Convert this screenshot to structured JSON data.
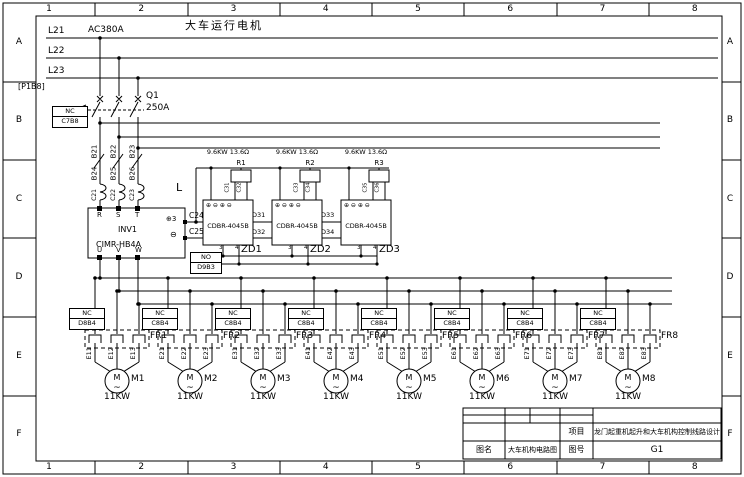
{
  "border": {
    "cols": [
      "1",
      "2",
      "3",
      "4",
      "5",
      "6",
      "7",
      "8"
    ],
    "rows": [
      "A",
      "B",
      "C",
      "D",
      "E",
      "F"
    ]
  },
  "power": {
    "title": "大车运行电机",
    "voltage": "AC380A",
    "ref": "[P1B8]",
    "lines": [
      "L21",
      "L22",
      "L23"
    ]
  },
  "breaker": {
    "name": "Q1",
    "rating": "250A",
    "nc_label": "NC",
    "nc_code": "C7B8"
  },
  "feeder": {
    "wires_in": [
      "B21",
      "B22",
      "B23"
    ],
    "wires_mid": [
      "B24",
      "B25",
      "B26"
    ],
    "wires_out": [
      "C21",
      "C22",
      "C23"
    ],
    "reactor": "L"
  },
  "inverter": {
    "name": "INV1",
    "model": "CIMR-HB4A",
    "in": [
      "R",
      "S",
      "T"
    ],
    "out": [
      "U",
      "V",
      "W"
    ],
    "dc_plus_sym": "⊕3",
    "dc_minus_sym": "⊖",
    "dc_plus_wire": "C24",
    "dc_minus_wire": "C25"
  },
  "no_box": {
    "label": "NO",
    "code": "D9B3"
  },
  "braking": {
    "terminals": "⊕ ⊖ ⊕ ⊖",
    "links": [
      "D31",
      "D32",
      "D33",
      "D34"
    ],
    "units": [
      {
        "name": "ZD1",
        "model": "CDBR-4045B",
        "resistor": "R1",
        "spec": "9.6KW 13.6Ω",
        "lead1": "C31",
        "lead2": "C32",
        "t3": "3",
        "t4": "4"
      },
      {
        "name": "ZD2",
        "model": "CDBR-4045B",
        "resistor": "R2",
        "spec": "9.6KW 13.6Ω",
        "lead1": "C33",
        "lead2": "C34",
        "t3": "3",
        "t4": "4"
      },
      {
        "name": "ZD3",
        "model": "CDBR-4045B",
        "resistor": "R3",
        "spec": "9.6KW 13.6Ω",
        "lead1": "C35",
        "lead2": "C36",
        "t3": "3",
        "t4": "4"
      }
    ]
  },
  "motor_glyph": {
    "letter": "M",
    "wave": "~"
  },
  "motors": [
    {
      "name": "M1",
      "power": "11KW",
      "fr": "FR1",
      "nc": "NC",
      "code": "D8B4",
      "wires": [
        "E11",
        "E12",
        "E13"
      ]
    },
    {
      "name": "M2",
      "power": "11KW",
      "fr": "FR2",
      "nc": "NC",
      "code": "C8B4",
      "wires": [
        "E21",
        "E22",
        "E23"
      ]
    },
    {
      "name": "M3",
      "power": "11KW",
      "fr": "FR3",
      "nc": "NC",
      "code": "C8B4",
      "wires": [
        "E31",
        "E32",
        "E33"
      ]
    },
    {
      "name": "M4",
      "power": "11KW",
      "fr": "FR4",
      "nc": "NC",
      "code": "C8B4",
      "wires": [
        "E41",
        "E42",
        "E43"
      ]
    },
    {
      "name": "M5",
      "power": "11KW",
      "fr": "FR5",
      "nc": "NC",
      "code": "C8B4",
      "wires": [
        "E51",
        "E52",
        "E53"
      ]
    },
    {
      "name": "M6",
      "power": "11KW",
      "fr": "FR6",
      "nc": "NC",
      "code": "C8B4",
      "wires": [
        "E61",
        "E62",
        "E63"
      ]
    },
    {
      "name": "M7",
      "power": "11KW",
      "fr": "FR7",
      "nc": "NC",
      "code": "C8B4",
      "wires": [
        "E71",
        "E72",
        "E73"
      ]
    },
    {
      "name": "M8",
      "power": "11KW",
      "fr": "FR8",
      "nc": "NC",
      "code": "C8B4",
      "wires": [
        "E81",
        "E82",
        "E83"
      ]
    }
  ],
  "titleblock": {
    "project_label": "项目",
    "project": "龙门起重机起升和大车机构控制线路设计",
    "name_label": "图名",
    "name": "大车机构电路图",
    "no_label": "图号",
    "no": "G1"
  }
}
